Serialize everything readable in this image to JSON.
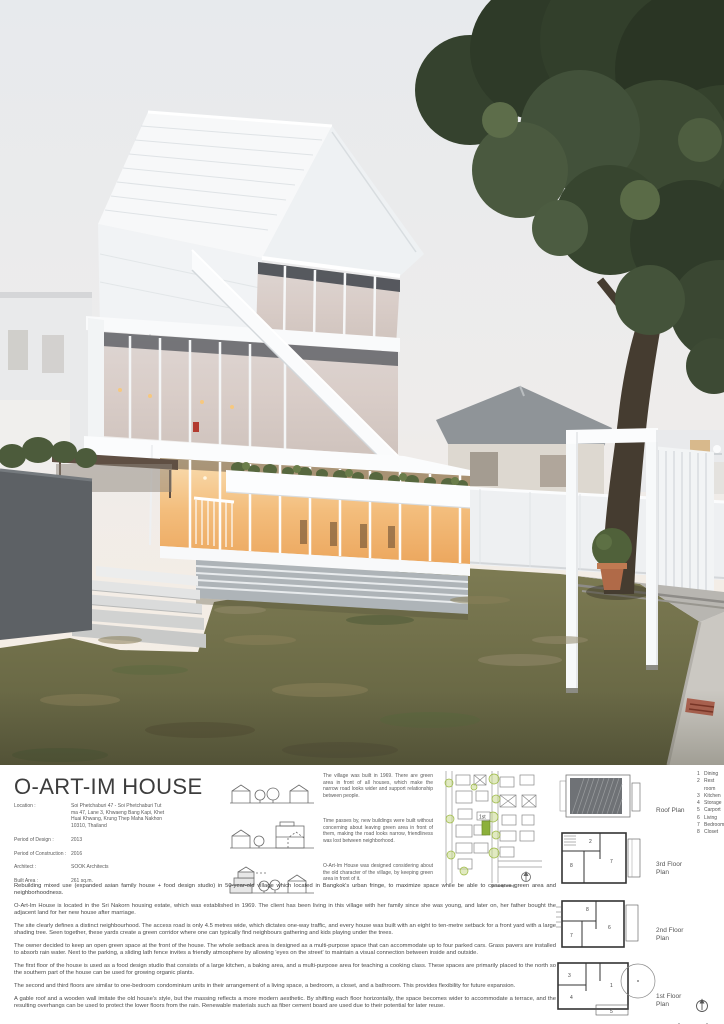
{
  "board": {
    "title": "O-ART-IM HOUSE",
    "info": [
      {
        "label": "Location :",
        "value": "Soi Phetchaburi 47 - Soi Phetchaburi Tut ma 47, Lane 3, Khwaeng Bang Kapi, Khet Huai Khwang, Krung Thep Maha Nakhon 10310, Thailand"
      },
      {
        "label": "Period of Design :",
        "value": "2013"
      },
      {
        "label": "Period of Construction :",
        "value": "2016"
      },
      {
        "label": "Architect :",
        "value": "SOOK Architects"
      },
      {
        "label": "Built Area :",
        "value": "261 sq.m."
      }
    ],
    "concepts": [
      {
        "caption": "The village was built in 1969. There are green area in front of all houses, which make the narrow road looks wider and support relationship between people."
      },
      {
        "caption": "Time passes by, new buildings were built without concerning about leaving green area in front of them, making the road looks narrow, friendliness was lost between neighborhood."
      },
      {
        "caption": "O-Art-Im House was designed considering about the old character of the village, by keeping green area in front of it."
      }
    ],
    "site_plan": {
      "site_label": "1st"
    },
    "legend": [
      {
        "n": "1",
        "label": "Dining"
      },
      {
        "n": "2",
        "label": "Rest room"
      },
      {
        "n": "3",
        "label": "Kitchen"
      },
      {
        "n": "4",
        "label": "Storage"
      },
      {
        "n": "5",
        "label": "Carport"
      },
      {
        "n": "6",
        "label": "Living"
      },
      {
        "n": "7",
        "label": "Bedroom"
      },
      {
        "n": "8",
        "label": "Closet"
      }
    ],
    "plans": [
      {
        "label": "Roof Plan"
      },
      {
        "label": "3rd Floor Plan"
      },
      {
        "label": "2nd Floor Plan"
      },
      {
        "label": "1st Floor Plan"
      }
    ],
    "paragraphs": [
      "Rebuilding mixed use (expanded asian family house + food design studio) in 50-year-old village which located in Bangkok's urban fringe, to maximize space while be able to conserve green area and neighborhoodness.",
      "O-Art-Im House is located in the Sri Nakorn housing estate, which was established in 1969. The client has been living in this village with her family since she was young, and later on, her father bought the adjacent land for her new house after marriage.",
      "The site clearly defines a distinct neighbourhood. The access road is only 4.5 metres wide, which dictates one-way traffic, and every house was built with an eight to ten-metre setback for a front yard with a large shading tree. Seen together, these yards create a green corridor where one can typically find neighbours gathering and kids playing under the trees.",
      "The owner decided to keep an open green space at the front of the house. The whole setback area is designed as a multi-purpose space that can accommodate up to four parked cars. Grass pavers are installed to absorb rain water. Next to the parking, a sliding lath fence invites a friendly atmosphere by allowing 'eyes on the street' to maintain a visual connection between inside and outside.",
      "The first floor of the house is used as a food design studio that consists of a large kitchen, a baking area, and a multi-purpose area for teaching a cooking class. These spaces are primarily placed to the north so the southern part of the house can be used for growing organic plants.",
      "The second and third floors are similar to one-bedroom condominium units in their arrangement of a living space, a bedroom, a closet, and a bathroom. This provides flexibility for future expansion.",
      "A gable roof and a wooden wall imitate the old house's style, but the massing reflects a more modern aesthetic. By shifting each floor horizontally, the space becomes wider to accommodate a terrace, and the resulting overhangs can be used to protect the lower floors from the rain. Renewable materials such as fiber cement board are used due to their potential for later reuse."
    ]
  },
  "colors": {
    "site_accent_green": "#8cb03b",
    "warm_window_glow": "#f3bd7c",
    "sky": "#e9ebee",
    "tree_canopy": "#33402b",
    "lawn": "#73744c",
    "body_text": "#4a4a4a"
  }
}
